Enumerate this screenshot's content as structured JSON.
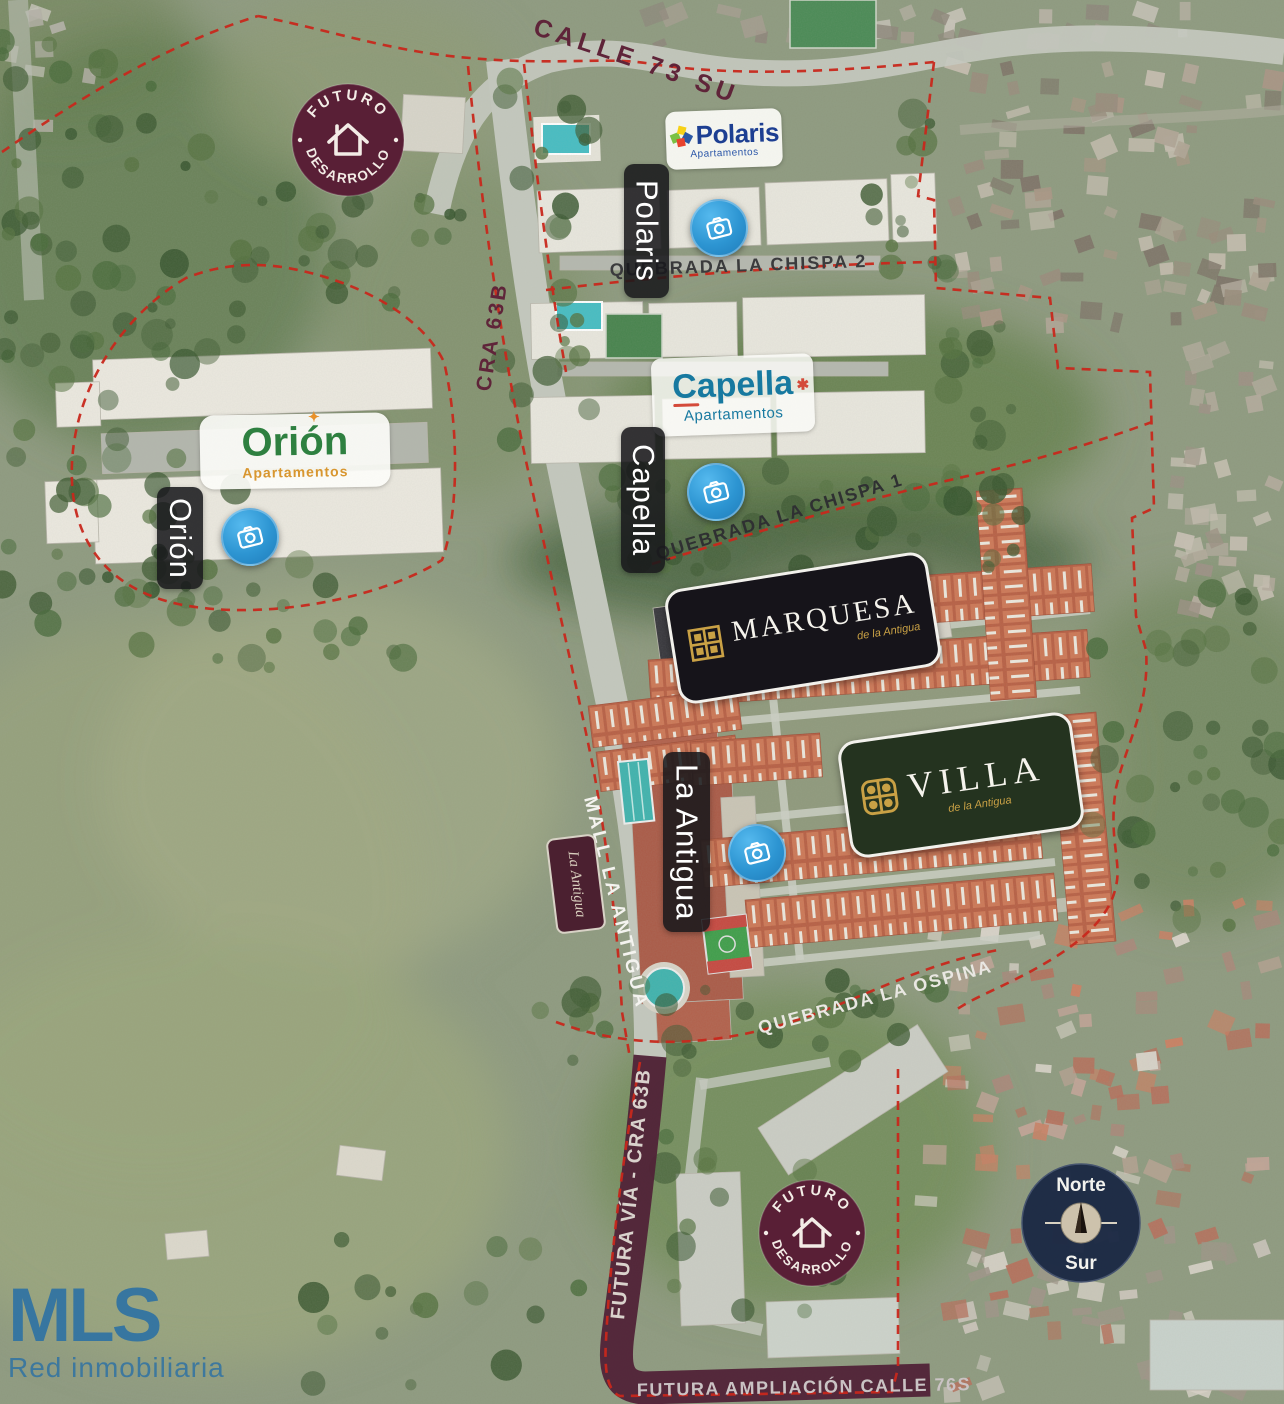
{
  "roads": {
    "calle_73_sur": "CALLE 73 SUR",
    "cra_63b": "CRA 63B",
    "mall_la_antigua": "MALL LA ANTIGUA",
    "futura_via_cra_63b": "FUTURA VÍA - CRA 63B",
    "futura_ampliacion_calle_76s": "FUTURA AMPLIACIÓN CALLE 76S"
  },
  "waterways": {
    "quebrada_la_chispa_2": "QUEBRADA LA CHISPA 2",
    "quebrada_la_chispa_1": "QUEBRADA LA CHISPA 1",
    "quebrada_la_ospina": "QUEBRADA LA OSPINA"
  },
  "future_development_badge": {
    "top": "FUTURO",
    "bottom": "DESARROLLO"
  },
  "projects": {
    "polaris": {
      "name": "Polaris",
      "subtitle": "Apartamentos",
      "marker_label": "Polaris"
    },
    "capella": {
      "name": "Capella",
      "subtitle": "Apartamentos",
      "marker_label": "Capella"
    },
    "orion": {
      "name": "Orión",
      "subtitle": "Apartamentos",
      "marker_label": "Orión"
    },
    "marquesa": {
      "name": "MARQUESA",
      "subtitle": "de la Antigua"
    },
    "villa": {
      "name": "VILLA",
      "subtitle": "de la Antigua"
    },
    "la_antigua": {
      "marker_label": "La Antigua",
      "mall_sign": "La Antigua"
    }
  },
  "compass": {
    "north": "Norte",
    "south": "Sur"
  },
  "brand": {
    "name": "MLS",
    "tagline": "Red inmobiliaria"
  },
  "colors": {
    "boundary_red": "#c8281c",
    "road_maroon": "#5f2439",
    "badge_maroon": "#591f36",
    "camera_blue": "#2f9ad6",
    "gold": "#c9a145",
    "mls_blue": "#2f72a3"
  }
}
